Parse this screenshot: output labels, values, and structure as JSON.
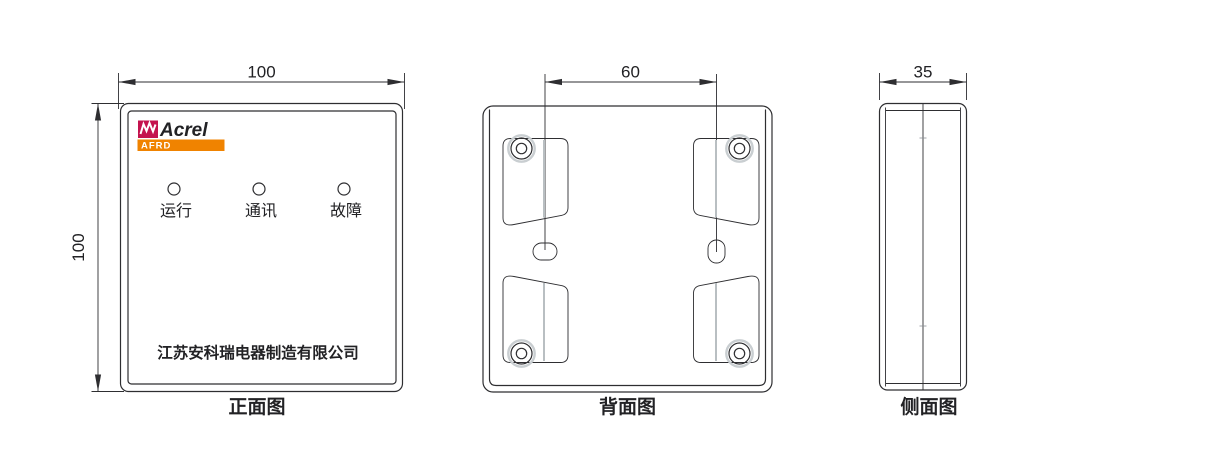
{
  "drawing": {
    "front": {
      "caption": "正面图",
      "dim_width": "100",
      "dim_height": "100",
      "logo_brand": "Acrel",
      "logo_model": "AFRD",
      "led_labels": [
        "运行",
        "通讯",
        "故障"
      ],
      "company": "江苏安科瑞电器制造有限公司"
    },
    "back": {
      "caption": "背面图",
      "dim_hole_spacing": "60"
    },
    "side": {
      "caption": "侧面图",
      "dim_depth": "35"
    },
    "colors": {
      "logo_red": "#c4134e",
      "logo_orange": "#f08300",
      "brand_text": "#1c1b33",
      "line": "#2e2e31"
    }
  }
}
